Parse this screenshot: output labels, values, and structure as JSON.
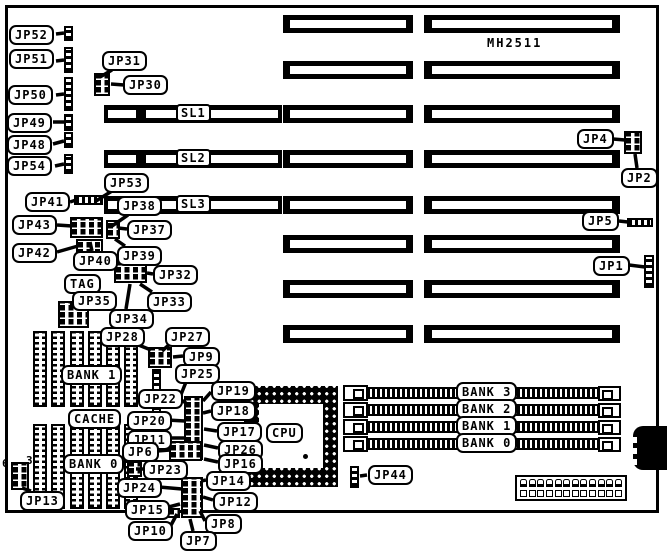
{
  "chipset_label": "MH2511",
  "cpu_label": "CPU",
  "jp13_pin_numbers": {
    "pin6": "6",
    "pin3": "3"
  },
  "slots": {
    "sl1": "SL1",
    "sl2": "SL2",
    "sl3": "SL3"
  },
  "memory_banks": {
    "bank3": "BANK 3",
    "bank2": "BANK 2",
    "bank1": "BANK 1",
    "bank0": "BANK 0"
  },
  "cache_labels": {
    "bank1": "BANK 1",
    "cache": "CACHE",
    "bank0": "BANK 0",
    "tag": "TAG"
  },
  "jumpers": {
    "jp1": "JP1",
    "jp2": "JP2",
    "jp4": "JP4",
    "jp5": "JP5",
    "jp6": "JP6",
    "jp7": "JP7",
    "jp8": "JP8",
    "jp9": "JP9",
    "jp10": "JP10",
    "jp11": "JP11",
    "jp12": "JP12",
    "jp13": "JP13",
    "jp14": "JP14",
    "jp15": "JP15",
    "jp16": "JP16",
    "jp17": "JP17",
    "jp18": "JP18",
    "jp19": "JP19",
    "jp20": "JP20",
    "jp22": "JP22",
    "jp23": "JP23",
    "jp24": "JP24",
    "jp25": "JP25",
    "jp26": "JP26",
    "jp27": "JP27",
    "jp28": "JP28",
    "jp30": "JP30",
    "jp31": "JP31",
    "jp32": "JP32",
    "jp33": "JP33",
    "jp34": "JP34",
    "jp35": "JP35",
    "jp37": "JP37",
    "jp38": "JP38",
    "jp39": "JP39",
    "jp40": "JP40",
    "jp41": "JP41",
    "jp42": "JP42",
    "jp43": "JP43",
    "jp44": "JP44",
    "jp48": "JP48",
    "jp49": "JP49",
    "jp50": "JP50",
    "jp51": "JP51",
    "jp52": "JP52",
    "jp53": "JP53",
    "jp54": "JP54"
  }
}
